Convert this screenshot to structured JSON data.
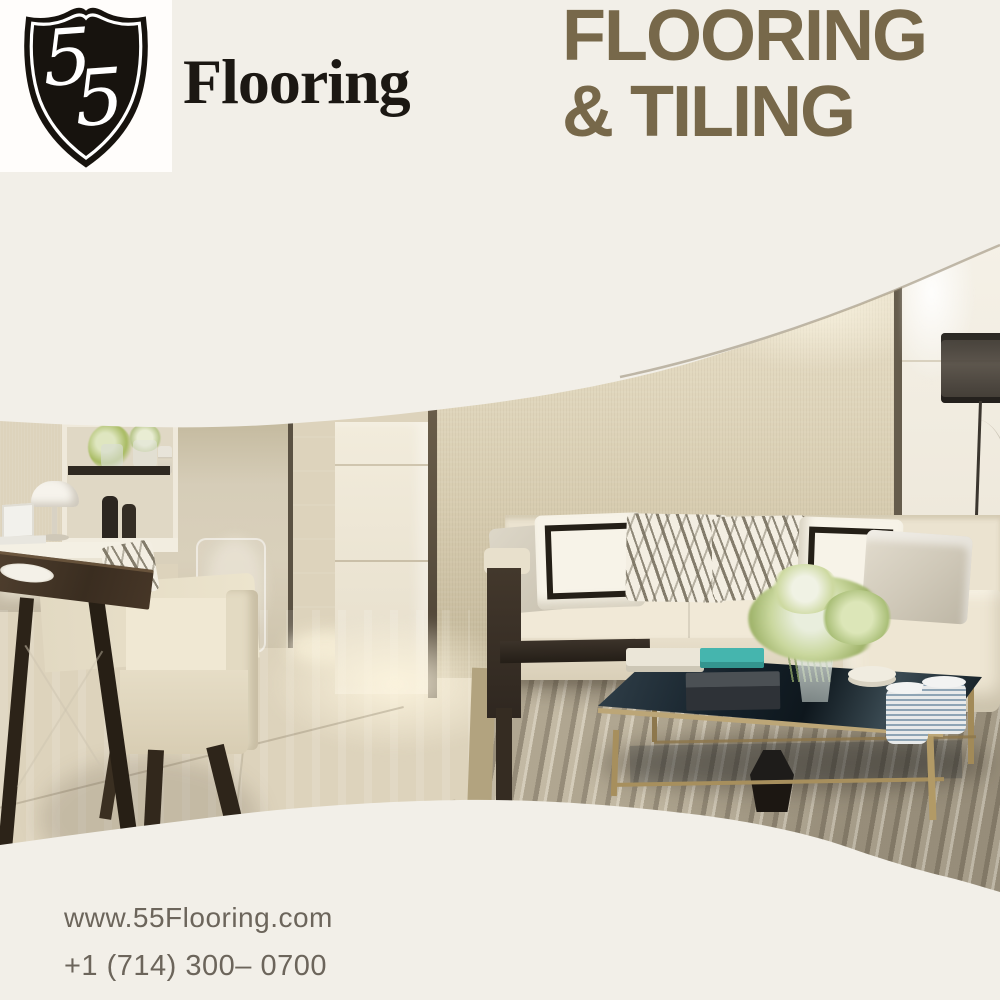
{
  "brand": {
    "logo_number": "55",
    "logo_text": "Flooring",
    "logo_alt": "55 Flooring black shield logo"
  },
  "headline": {
    "line1": "FLOORING",
    "line2": "& TILING"
  },
  "cta": {
    "label": "BOOK NOW"
  },
  "contact": {
    "website": "www.55Flooring.com",
    "phone": "+1 (714) 300– 0700"
  },
  "colors": {
    "background_cream": "#f2efe8",
    "headline_brown": "#77684a",
    "button_brown": "#746750",
    "button_text": "#f3f0e6",
    "logo_black": "#1c1813",
    "contact_text": "#6c655b"
  },
  "photo": {
    "description": "Modern luxury living room: cream sectional sofa with zebra-print and black-bordered pillows, dark glass coffee table with brass frame, flower bouquet, striped area rug, dark wood dining table with cream chair, white shelf unit with vases and lamp, glossy tile floor, black drum floor lamp"
  }
}
